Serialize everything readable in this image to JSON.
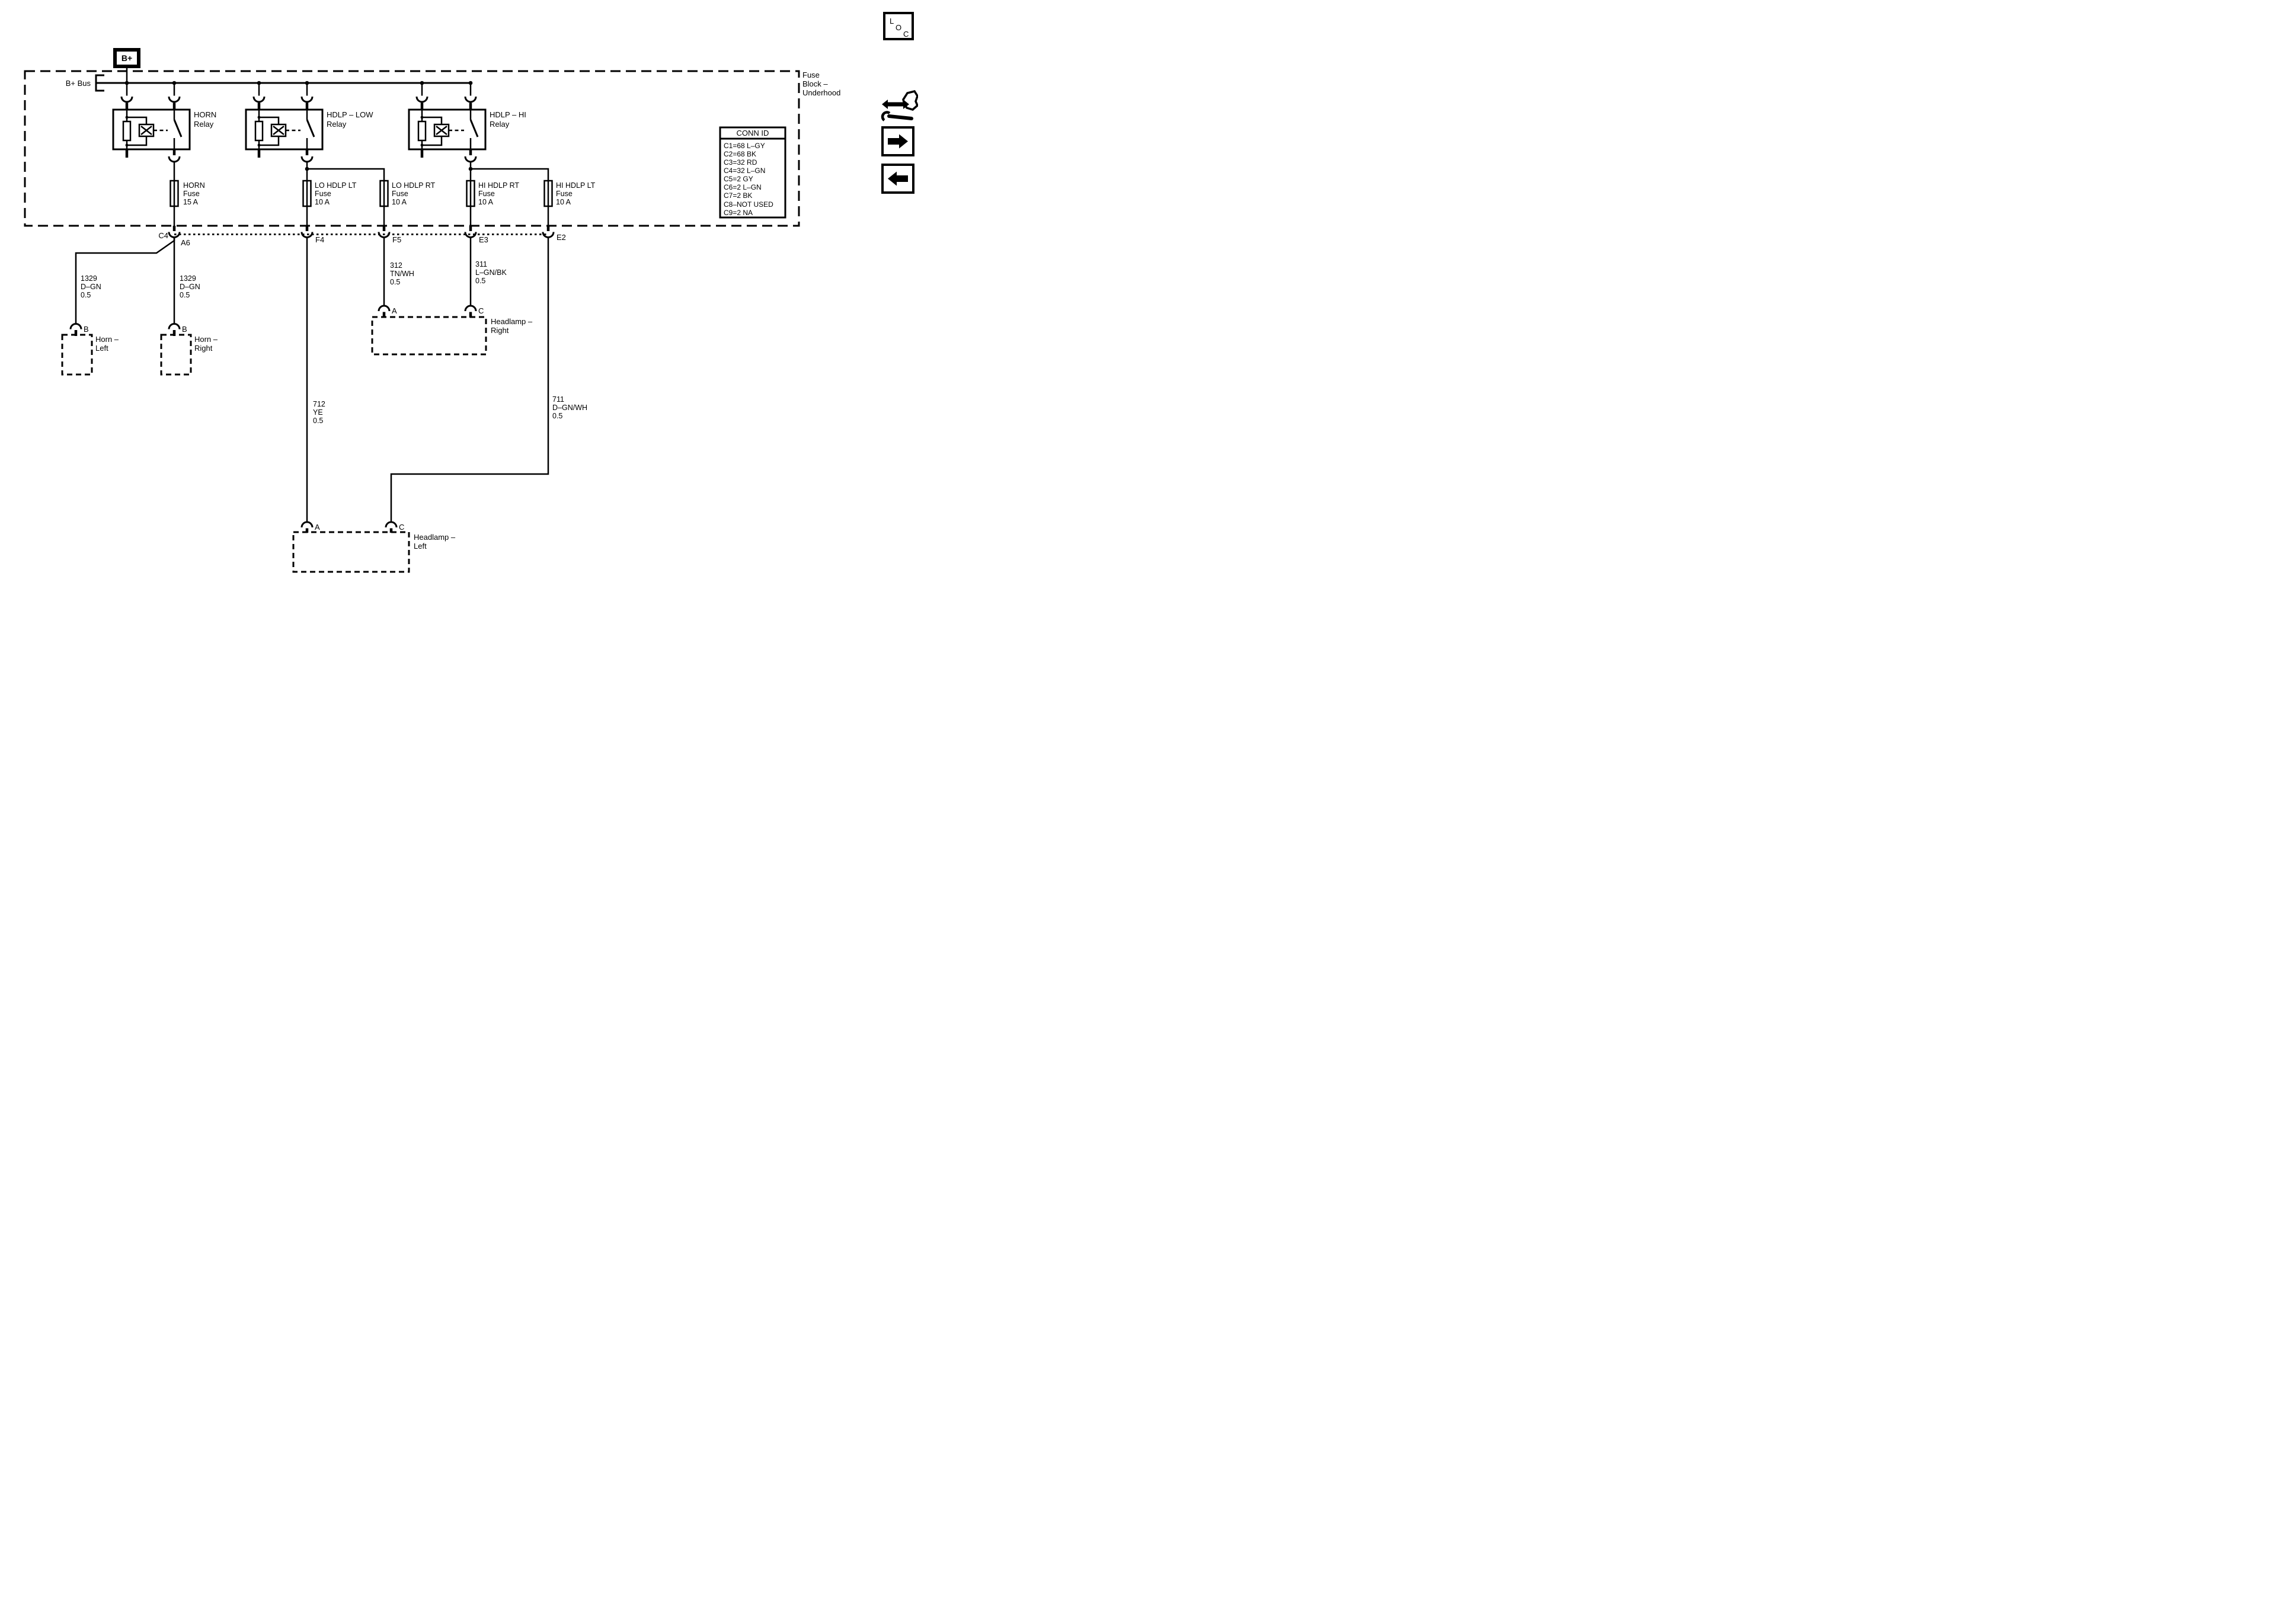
{
  "diagram": {
    "colors": {
      "ink": "#000000",
      "paper": "#ffffff"
    },
    "loc_tag": {
      "letters": [
        "L",
        "O",
        "C"
      ]
    },
    "fuse_block": {
      "label_lines": [
        "Fuse",
        "Block –",
        "Underhood"
      ]
    },
    "power": {
      "source": "B+",
      "bus": "B+ Bus"
    },
    "relays": [
      {
        "line1": "HORN",
        "line2": "Relay"
      },
      {
        "line1": "HDLP – LOW",
        "line2": "Relay"
      },
      {
        "line1": "HDLP – HI",
        "line2": "Relay"
      }
    ],
    "fuses": [
      {
        "name": "HORN",
        "type": "Fuse",
        "rating": "15 A"
      },
      {
        "name": "LO HDLP LT",
        "type": "Fuse",
        "rating": "10 A"
      },
      {
        "name": "LO HDLP RT",
        "type": "Fuse",
        "rating": "10 A"
      },
      {
        "name": "HI HDLP RT",
        "type": "Fuse",
        "rating": "10 A"
      },
      {
        "name": "HI HDLP LT",
        "type": "Fuse",
        "rating": "10 A"
      }
    ],
    "connector_pins": {
      "c4": "C4",
      "a6": "A6",
      "f4": "F4",
      "f5": "F5",
      "e3": "E3",
      "e2": "E2"
    },
    "wires": [
      {
        "circuit": "1329",
        "color": "D–GN",
        "gauge": "0.5"
      },
      {
        "circuit": "1329",
        "color": "D–GN",
        "gauge": "0.5"
      },
      {
        "circuit": "312",
        "color": "TN/WH",
        "gauge": "0.5"
      },
      {
        "circuit": "311",
        "color": "L–GN/BK",
        "gauge": "0.5"
      },
      {
        "circuit": "712",
        "color": "YE",
        "gauge": "0.5"
      },
      {
        "circuit": "711",
        "color": "D–GN/WH",
        "gauge": "0.5"
      }
    ],
    "component_pins": {
      "horn_left": "B",
      "horn_right": "B",
      "headlamp_right_low": "A",
      "headlamp_right_high": "C",
      "headlamp_left_low": "A",
      "headlamp_left_high": "C"
    },
    "components": [
      {
        "line1": "Horn –",
        "line2": "Left"
      },
      {
        "line1": "Horn –",
        "line2": "Right"
      },
      {
        "line1": "Headlamp –",
        "line2": "Right"
      },
      {
        "line1": "Headlamp –",
        "line2": "Left"
      }
    ],
    "conn_id": {
      "title": "CONN ID",
      "rows": [
        "C1=68 L–GY",
        "C2=68 BK",
        "C3=32 RD",
        "C4=32 L–GN",
        "C5=2 GY",
        "C6=2 L–GN",
        "C7=2 BK",
        "C8–NOT USED",
        "C9=2 NA"
      ]
    }
  }
}
